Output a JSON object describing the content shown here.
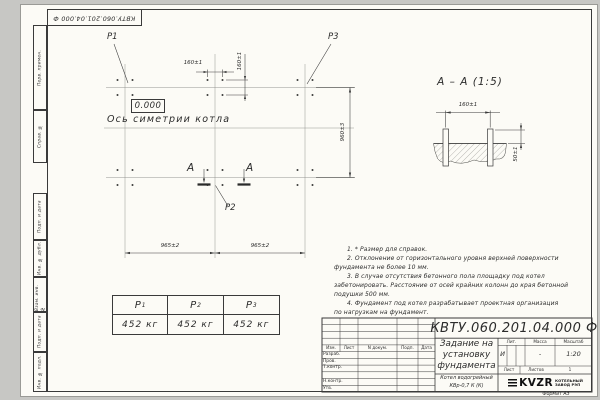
{
  "frame": {
    "stamp_number": "КВТУ.060.201.04.000  Ф",
    "format_label": "Формат А3",
    "margin_labels": [
      "Перв. примен.",
      "Справ. №",
      "Подп. и дата",
      "Инв. № дубл.",
      "Взам. инв. №",
      "Подп. и дата",
      "Инв. № подл."
    ]
  },
  "plan": {
    "point_labels": {
      "p1": "P1",
      "p2": "P2",
      "p3": "P3"
    },
    "elevation": "0.000",
    "axis_label": "Ось симетрии котла",
    "dims": {
      "bolt_spacing_x": "160±1",
      "bolt_spacing_y": "160±1",
      "row_spacing": "960±3",
      "col_spacing_left": "965±2",
      "col_spacing_right": "965±2"
    },
    "section_letters": [
      "А",
      "А"
    ]
  },
  "section_view": {
    "title": "А – А (1:5)",
    "dims": {
      "bolt_spacing": "160±1",
      "protrusion": "50±1"
    }
  },
  "loads_table": {
    "columns": [
      {
        "name": "P",
        "sub": "1",
        "value": "452 кг"
      },
      {
        "name": "P",
        "sub": "2",
        "value": "452 кг"
      },
      {
        "name": "P",
        "sub": "3",
        "value": "452 кг"
      }
    ]
  },
  "notes": {
    "lines": [
      {
        "text": "1. * Размер для справок."
      },
      {
        "text": "2. Отклонение от горизонтального уровня верхней поверхности"
      },
      {
        "text": "фундамента не более 10 мм."
      },
      {
        "text": "3. В случае отсутствия бетонного пола площадку под котел"
      },
      {
        "text": "забетонировать. Расстояние от осей крайних колонн до края бетонной"
      },
      {
        "text": "подушки 500 мм."
      },
      {
        "text": "4. Фундамент под котел разрабатывает проектная организация"
      },
      {
        "text": "по нагрузкам на фундамент."
      }
    ]
  },
  "title_block": {
    "doc_number": "КВТУ.060.201.04.000  Ф",
    "rev_cols": [
      "Изм.",
      "Лист",
      "N докум.",
      "Подп.",
      "Дата"
    ],
    "roles": [
      "Разраб.",
      "Пров.",
      "Т.контр.",
      "Н.контр.",
      "Утв."
    ],
    "title_lines": [
      "Задание на",
      "установку",
      "фундамента"
    ],
    "props": {
      "lit_label": "Лит.",
      "mass_label": "Масса",
      "scale_label": "Масштаб",
      "lit": "И",
      "mass": "-",
      "scale": "1:20",
      "sheet_label": "Лист",
      "sheets_label": "Листов",
      "sheets_value": "1"
    },
    "product_lines": [
      "Котел водогрейный",
      "КВр-0,7 К (К)"
    ],
    "logo": {
      "text": "KVZR",
      "caption_lines": [
        "КОТЕЛЬНЫЙ",
        "ЗАВОД РЭП"
      ]
    }
  }
}
